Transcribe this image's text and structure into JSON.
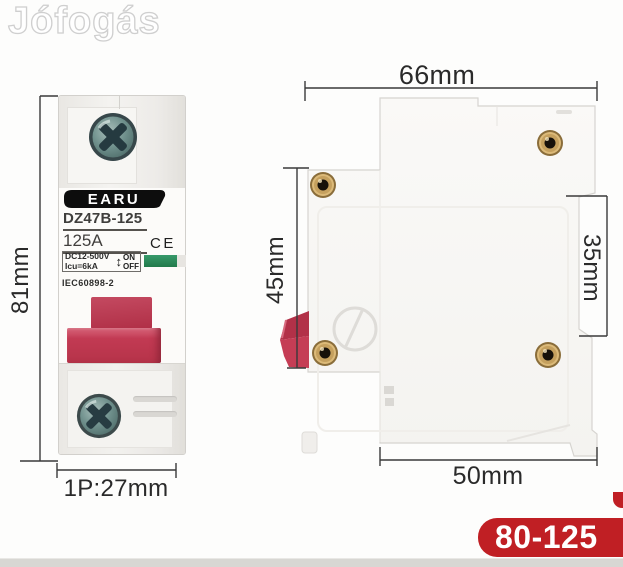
{
  "watermark": {
    "text": "Jófogás"
  },
  "front_view": {
    "brand": "EARU",
    "model": "DZ47B-125",
    "current_rating": "125A",
    "ce_mark": "CE",
    "voltage_spec": "DC12-500V",
    "breaking_capacity": "Icu=6kA",
    "arrow_icon": "↕",
    "on_label": "ON",
    "off_label": "OFF",
    "standard": "IEC60898-2"
  },
  "dimensions": {
    "top_width": "66mm",
    "overall_height": "81mm",
    "front_section_height": "45mm",
    "din_rail_gap": "35mm",
    "base_width": "50mm",
    "pole_width": "1P:27mm"
  },
  "badge": {
    "text": "80-125"
  },
  "colors": {
    "badge_red": "#c01f24",
    "toggle_red": "#c23a52",
    "indicator_green": "#2e8b57",
    "rivet_brass": "#d2ab66",
    "screw_teal": "#7b9894",
    "bottom_strip_gray": "#d8d7d3"
  }
}
